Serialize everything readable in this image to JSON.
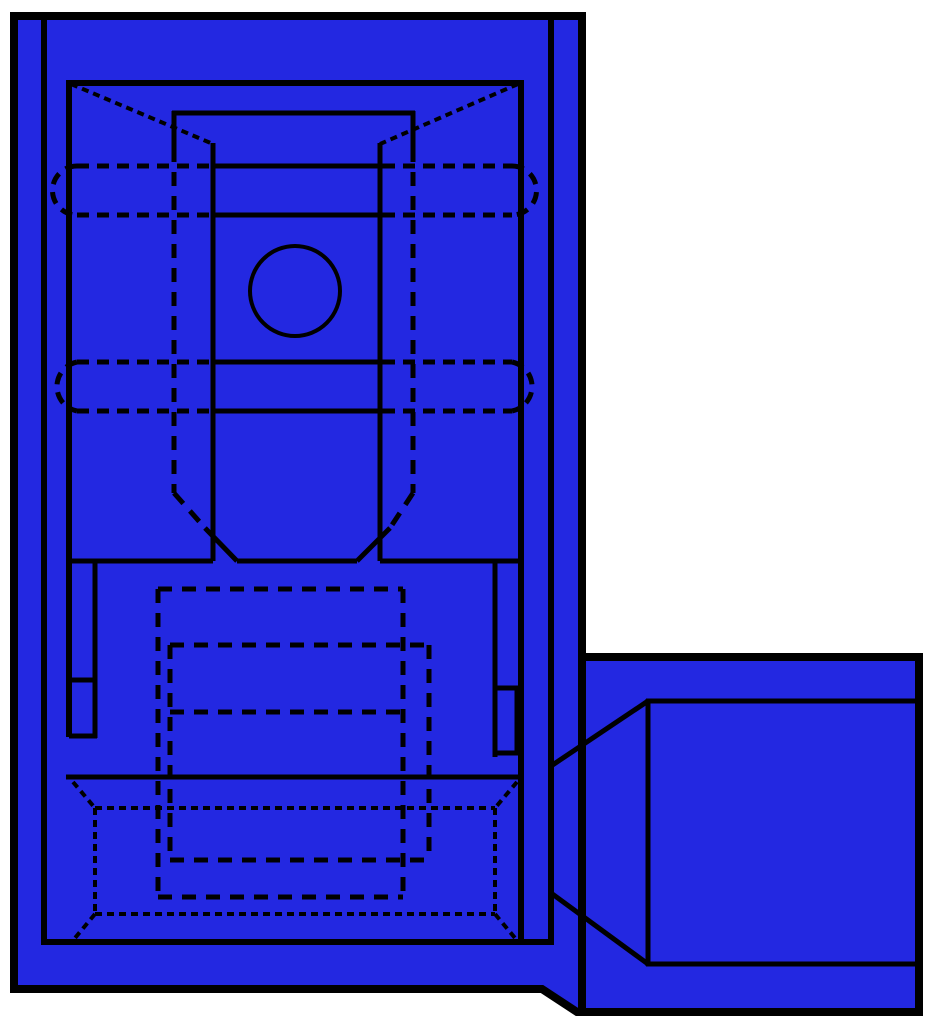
{
  "canvas": {
    "width": 936,
    "height": 1024,
    "background": "#ffffff"
  },
  "palette": {
    "part_fill": "#2328e1",
    "line": "#000000",
    "background": "#ffffff"
  },
  "drawing_title": "blue-insulated-flag-disconnect-terminal-line-drawing",
  "styles": {
    "outline": {
      "w": 8,
      "da": null
    },
    "bold": {
      "w": 6,
      "da": null
    },
    "solid": {
      "w": 5,
      "da": null
    },
    "thin": {
      "w": 4,
      "da": null
    },
    "dash": {
      "w": 5,
      "da": "14,10"
    },
    "dash2": {
      "w": 5,
      "da": "12,8"
    },
    "dot": {
      "w": 4,
      "da": "7,5"
    }
  },
  "shapes": [
    {
      "name": "outer-housing-outline",
      "s": "outline",
      "fill": true,
      "d": "M14,16 L582,16 L582,657 L919,657 L919,1012 L577,1012 L542,989 L14,989 Z"
    },
    {
      "name": "housing-box-shared-edge",
      "s": "outline",
      "x1": 582,
      "y1": 657,
      "x2": 582,
      "y2": 1012
    },
    {
      "name": "inner-shell-left",
      "s": "bold",
      "x1": 44,
      "y1": 20,
      "x2": 44,
      "y2": 942
    },
    {
      "name": "inner-shell-right",
      "s": "bold",
      "x1": 551,
      "y1": 20,
      "x2": 551,
      "y2": 942
    },
    {
      "name": "inner-shell-bottom",
      "s": "bold",
      "x1": 41,
      "y1": 942,
      "x2": 554,
      "y2": 942
    },
    {
      "name": "liner-top",
      "s": "bold",
      "x1": 66,
      "y1": 83,
      "x2": 521,
      "y2": 83
    },
    {
      "name": "liner-left",
      "s": "bold",
      "x1": 69,
      "y1": 80,
      "x2": 69,
      "y2": 737
    },
    {
      "name": "liner-right",
      "s": "bold",
      "x1": 521,
      "y1": 80,
      "x2": 521,
      "y2": 942
    },
    {
      "name": "receptacle-top",
      "s": "solid",
      "x1": 172,
      "y1": 113,
      "x2": 415,
      "y2": 113
    },
    {
      "name": "receptacle-side-left-solid",
      "s": "solid",
      "x1": 174,
      "y1": 111,
      "x2": 174,
      "y2": 148
    },
    {
      "name": "receptacle-side-right-solid",
      "s": "solid",
      "x1": 413,
      "y1": 111,
      "x2": 413,
      "y2": 148
    },
    {
      "name": "contact-wall-left",
      "s": "solid",
      "x1": 213,
      "y1": 143,
      "x2": 213,
      "y2": 561
    },
    {
      "name": "contact-wall-right",
      "s": "solid",
      "x1": 380,
      "y1": 143,
      "x2": 380,
      "y2": 561
    },
    {
      "name": "corner-chamfer-left",
      "s": "dot",
      "x1": 71,
      "y1": 84,
      "x2": 213,
      "y2": 144
    },
    {
      "name": "corner-chamfer-right",
      "s": "dot",
      "x1": 518,
      "y1": 84,
      "x2": 380,
      "y2": 144
    },
    {
      "name": "crimp-band1-top-mid",
      "s": "solid",
      "x1": 212,
      "y1": 166,
      "x2": 383,
      "y2": 166
    },
    {
      "name": "crimp-band1-bottom-mid",
      "s": "solid",
      "x1": 212,
      "y1": 215,
      "x2": 383,
      "y2": 215
    },
    {
      "name": "crimp-band2-top-mid",
      "s": "solid",
      "x1": 212,
      "y1": 362,
      "x2": 383,
      "y2": 362
    },
    {
      "name": "crimp-band2-bottom-mid",
      "s": "solid",
      "x1": 212,
      "y1": 411,
      "x2": 383,
      "y2": 411
    },
    {
      "name": "crimp-band1-top-hidden-left",
      "s": "dash2",
      "x1": 77,
      "y1": 166,
      "x2": 212,
      "y2": 166
    },
    {
      "name": "crimp-band1-top-hidden-right",
      "s": "dash2",
      "x1": 383,
      "y1": 166,
      "x2": 512,
      "y2": 166
    },
    {
      "name": "crimp-band1-bottom-hidden-left",
      "s": "dash2",
      "x1": 77,
      "y1": 215,
      "x2": 212,
      "y2": 215
    },
    {
      "name": "crimp-band1-bottom-hidden-right",
      "s": "dash2",
      "x1": 383,
      "y1": 215,
      "x2": 512,
      "y2": 215
    },
    {
      "name": "crimp-band2-top-hidden-left",
      "s": "dash2",
      "x1": 77,
      "y1": 362,
      "x2": 212,
      "y2": 362
    },
    {
      "name": "crimp-band2-top-hidden-right",
      "s": "dash2",
      "x1": 383,
      "y1": 362,
      "x2": 512,
      "y2": 362
    },
    {
      "name": "crimp-band2-bottom-hidden-left",
      "s": "dash2",
      "x1": 77,
      "y1": 411,
      "x2": 212,
      "y2": 411
    },
    {
      "name": "crimp-band2-bottom-hidden-right",
      "s": "dash2",
      "x1": 383,
      "y1": 411,
      "x2": 512,
      "y2": 411
    },
    {
      "name": "crimp-band1-cap-left",
      "s": "dash2",
      "d": "M77,166 A24,24 0 0 0 77,215"
    },
    {
      "name": "crimp-band1-cap-right",
      "s": "dash2",
      "d": "M512,166 A24,24 0 0 1 512,215"
    },
    {
      "name": "crimp-band2-cap-left",
      "s": "dash2",
      "d": "M77,362 A25,25 0 0 0 77,411"
    },
    {
      "name": "crimp-band2-cap-right",
      "s": "dash2",
      "d": "M512,362 A25,25 0 0 1 512,411"
    },
    {
      "name": "stud-hole",
      "s": "thin",
      "cx": 295,
      "cy": 291,
      "r": 45
    },
    {
      "name": "receptacle-side-left-hidden",
      "s": "dash",
      "x1": 174,
      "y1": 148,
      "x2": 174,
      "y2": 493
    },
    {
      "name": "receptacle-side-right-hidden",
      "s": "dash",
      "x1": 413,
      "y1": 148,
      "x2": 413,
      "y2": 493
    },
    {
      "name": "tongue-chamfer-left-hidden",
      "s": "dash",
      "x1": 174,
      "y1": 493,
      "x2": 205,
      "y2": 528
    },
    {
      "name": "tongue-chamfer-right-hidden",
      "s": "dash",
      "x1": 413,
      "y1": 493,
      "x2": 390,
      "y2": 528
    },
    {
      "name": "tongue-chamfer-left",
      "s": "solid",
      "x1": 205,
      "y1": 528,
      "x2": 237,
      "y2": 561
    },
    {
      "name": "tongue-chamfer-right",
      "s": "solid",
      "x1": 390,
      "y1": 528,
      "x2": 357,
      "y2": 561
    },
    {
      "name": "shoulder-line-left",
      "s": "solid",
      "x1": 66,
      "y1": 561,
      "x2": 213,
      "y2": 561
    },
    {
      "name": "tongue-tip-line",
      "s": "solid",
      "x1": 237,
      "y1": 561,
      "x2": 357,
      "y2": 561
    },
    {
      "name": "shoulder-line-right",
      "s": "solid",
      "x1": 380,
      "y1": 561,
      "x2": 521,
      "y2": 561
    },
    {
      "name": "latch-slot-left-side",
      "s": "solid",
      "x1": 95,
      "y1": 563,
      "x2": 95,
      "y2": 738
    },
    {
      "name": "latch-slot-left-tick-upper",
      "s": "solid",
      "x1": 69,
      "y1": 680,
      "x2": 97,
      "y2": 680
    },
    {
      "name": "latch-slot-left-tick-lower",
      "s": "solid",
      "x1": 69,
      "y1": 736,
      "x2": 97,
      "y2": 736
    },
    {
      "name": "latch-slot-right-side",
      "s": "solid",
      "x1": 495,
      "y1": 563,
      "x2": 495,
      "y2": 757
    },
    {
      "name": "latch-slot-right-tick-upper",
      "s": "solid",
      "x1": 495,
      "y1": 688,
      "x2": 521,
      "y2": 688
    },
    {
      "name": "latch-slot-right-tick-lower",
      "s": "solid",
      "x1": 495,
      "y1": 753,
      "x2": 521,
      "y2": 753
    },
    {
      "name": "latch-slot-right-outer",
      "s": "solid",
      "x1": 517,
      "y1": 688,
      "x2": 517,
      "y2": 753
    },
    {
      "name": "sleeve-shoulder-line",
      "s": "solid",
      "x1": 66,
      "y1": 777,
      "x2": 521,
      "y2": 777
    },
    {
      "name": "sleeve-hidden-rect-top",
      "s": "dash",
      "x1": 158,
      "y1": 589,
      "x2": 403,
      "y2": 589
    },
    {
      "name": "sleeve-hidden-rect-left",
      "s": "dash",
      "x1": 158,
      "y1": 589,
      "x2": 158,
      "y2": 897
    },
    {
      "name": "sleeve-hidden-rect-right",
      "s": "dash",
      "x1": 403,
      "y1": 589,
      "x2": 403,
      "y2": 897
    },
    {
      "name": "sleeve-hidden-rect-bottom",
      "s": "dash",
      "x1": 158,
      "y1": 897,
      "x2": 403,
      "y2": 897
    },
    {
      "name": "barrel-hidden-rect-top",
      "s": "dash",
      "x1": 170,
      "y1": 645,
      "x2": 429,
      "y2": 645
    },
    {
      "name": "barrel-hidden-rect-left",
      "s": "dash",
      "x1": 170,
      "y1": 645,
      "x2": 170,
      "y2": 860
    },
    {
      "name": "barrel-hidden-rect-right",
      "s": "dash",
      "x1": 429,
      "y1": 645,
      "x2": 429,
      "y2": 860
    },
    {
      "name": "barrel-hidden-rect-bottom",
      "s": "dash",
      "x1": 170,
      "y1": 860,
      "x2": 429,
      "y2": 860
    },
    {
      "name": "barrel-hidden-mid-line",
      "s": "dash",
      "x1": 170,
      "y1": 712,
      "x2": 403,
      "y2": 712
    },
    {
      "name": "entry-flare-top",
      "s": "dot",
      "x1": 95,
      "y1": 808,
      "x2": 495,
      "y2": 808
    },
    {
      "name": "entry-flare-bottom",
      "s": "dot",
      "x1": 95,
      "y1": 914,
      "x2": 495,
      "y2": 914
    },
    {
      "name": "entry-flare-left",
      "s": "dot",
      "x1": 95,
      "y1": 808,
      "x2": 95,
      "y2": 914
    },
    {
      "name": "entry-flare-right",
      "s": "dot",
      "x1": 495,
      "y1": 808,
      "x2": 495,
      "y2": 914
    },
    {
      "name": "entry-flare-corner-tl",
      "s": "dot",
      "x1": 73,
      "y1": 782,
      "x2": 95,
      "y2": 808
    },
    {
      "name": "entry-flare-corner-tr",
      "s": "dot",
      "x1": 517,
      "y1": 782,
      "x2": 495,
      "y2": 808
    },
    {
      "name": "entry-flare-corner-bl",
      "s": "dot",
      "x1": 95,
      "y1": 914,
      "x2": 75,
      "y2": 938
    },
    {
      "name": "entry-flare-corner-br",
      "s": "dot",
      "x1": 495,
      "y1": 914,
      "x2": 515,
      "y2": 938
    },
    {
      "name": "wire-port-top",
      "s": "solid",
      "x1": 646,
      "y1": 701,
      "x2": 917,
      "y2": 701
    },
    {
      "name": "wire-port-bottom",
      "s": "solid",
      "x1": 646,
      "y1": 964,
      "x2": 917,
      "y2": 964
    },
    {
      "name": "wire-port-left",
      "s": "solid",
      "x1": 648,
      "y1": 699,
      "x2": 648,
      "y2": 966
    },
    {
      "name": "wire-port-chamfer-upper",
      "s": "solid",
      "x1": 551,
      "y1": 766,
      "x2": 648,
      "y2": 701
    },
    {
      "name": "wire-port-chamfer-lower",
      "s": "solid",
      "x1": 551,
      "y1": 893,
      "x2": 648,
      "y2": 964
    }
  ]
}
